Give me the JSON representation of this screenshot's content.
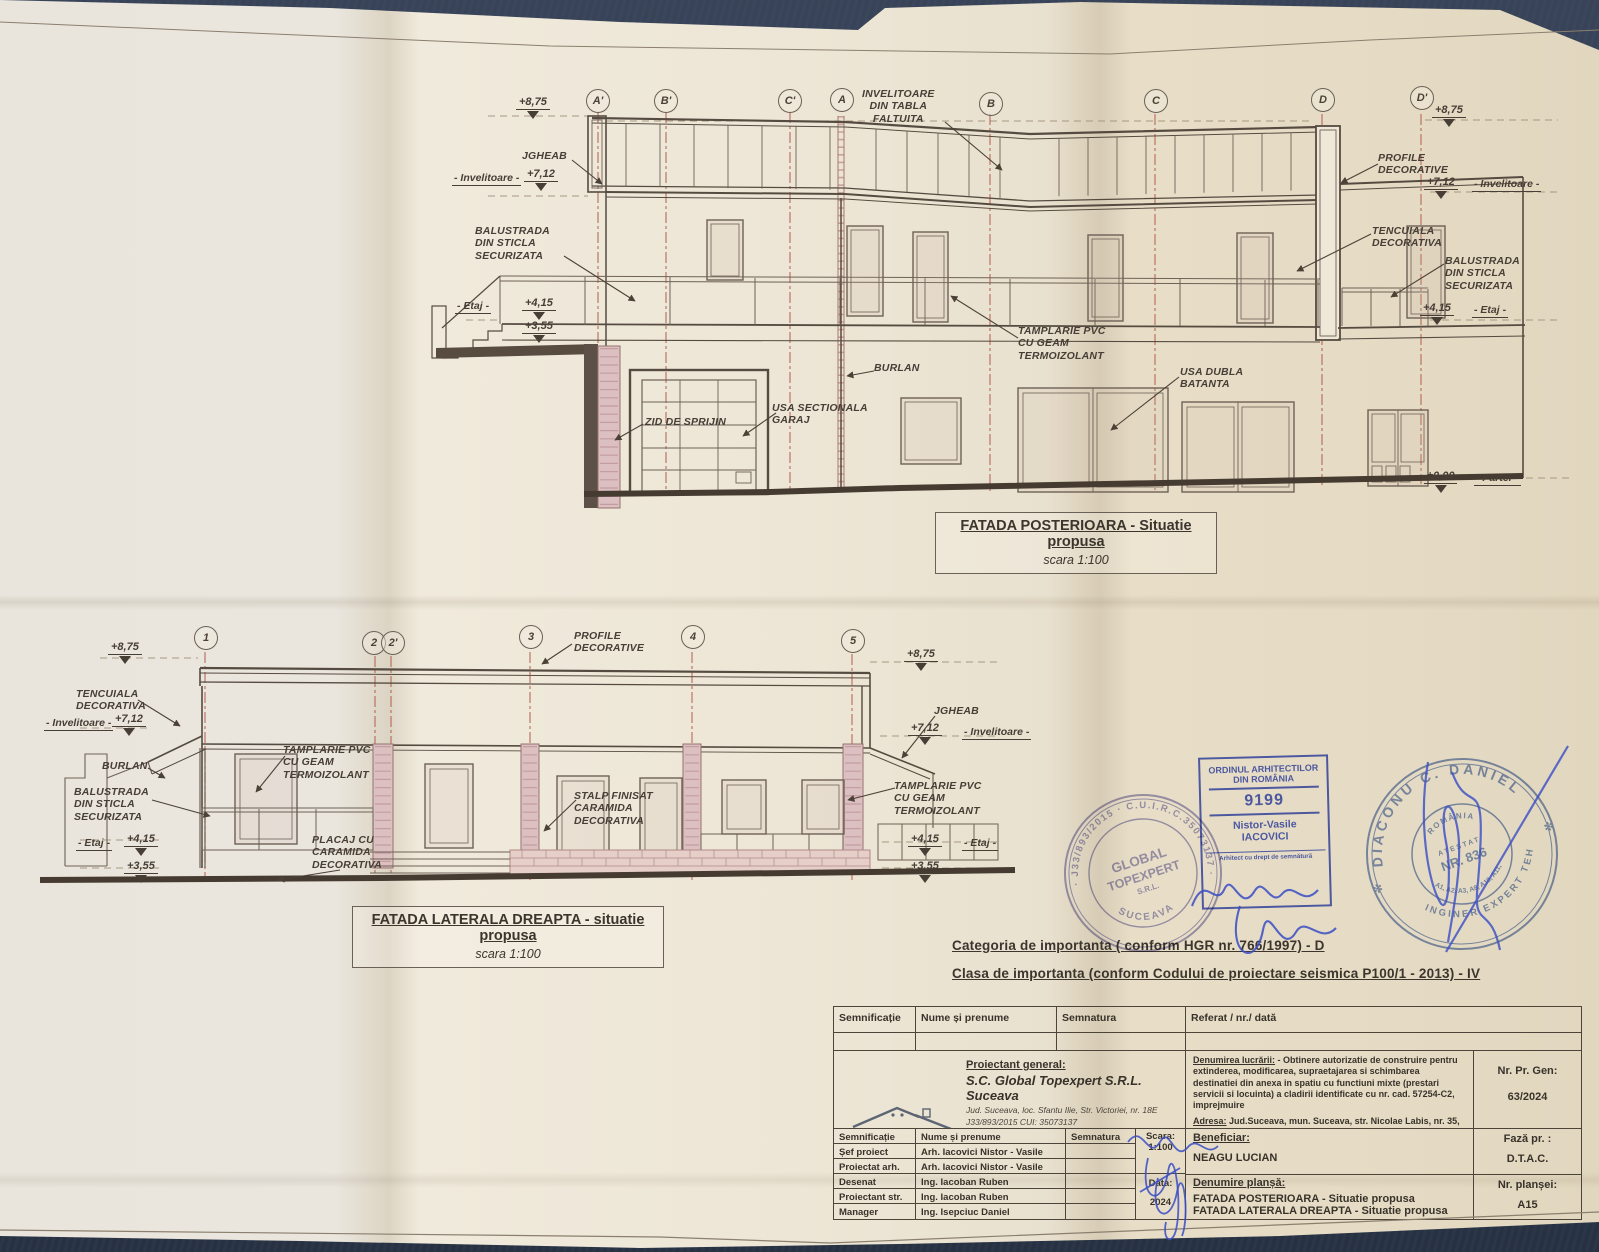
{
  "page": {
    "background": "#2e3a4e",
    "paper": "#eae4d7"
  },
  "top_drawing": {
    "bubbles": [
      "A'",
      "B'",
      "C'",
      "A",
      "B",
      "C",
      "D",
      "D'"
    ],
    "title": "FATADA POSTERIOARA - Situatie propusa",
    "scale": "scara 1:100",
    "labels": {
      "lvl875_left": "+8,75",
      "jgheab": "JGHEAB",
      "invelitoare_left": "- Invelitoare -",
      "lvl712_left": "+7,12",
      "balustrada_left": "BALUSTRADA\nDIN STICLA\nSECURIZATA",
      "etaj_left": "- Etaj -",
      "lvl415_left": "+4,15",
      "lvl355_left": "+3,55",
      "invelitoare_tabla": "INVELITOARE\nDIN TABLA\nFALTUITA",
      "tamplarie": "TAMPLARIE PVC\nCU GEAM\nTERMOIZOLANT",
      "burlan": "BURLAN",
      "usa_sectionala": "USA SECTIONALA\nGARAJ",
      "zid_de_sprijin": "ZID DE SPRIJIN",
      "usa_dubla": "USA DUBLA\nBATANTA",
      "lvl875_right": "+8,75",
      "profile_decorative": "PROFILE\nDECORATIVE",
      "lvl712_right": "+7,12",
      "invelitoare_right": "- Invelitoare -",
      "tencuiala": "TENCUIALA\nDECORATIVA",
      "balustrada_right": "BALUSTRADA\nDIN STICLA\nSECURIZATA",
      "lvl415_right": "+4,15",
      "etaj_right": "- Etaj -",
      "lvl000": "±0,00",
      "parter": "- Parter -"
    }
  },
  "bottom_drawing": {
    "bubbles": [
      "1",
      "2",
      "2'",
      "3",
      "4",
      "5"
    ],
    "title": "FATADA LATERALA DREAPTA - situatie propusa",
    "scale": "scara 1:100",
    "labels": {
      "lvl875_left": "+8,75",
      "tencuiala": "TENCUIALA\nDECORATIVA",
      "invelitoare_left": "- Invelitoare -",
      "lvl712_left": "+7,12",
      "burlan": "BURLAN",
      "balustrada": "BALUSTRADA\nDIN STICLA\nSECURIZATA",
      "etaj_left": "- Etaj -",
      "lvl415_left": "+4,15",
      "lvl355_left": "+3,55",
      "profile_decorative": "PROFILE\nDECORATIVE",
      "tamplarie_mid": "TAMPLARIE PVC\nCU GEAM\nTERMOIZOLANT",
      "placaj": "PLACAJ CU\nCARAMIDA\nDECORATIVA",
      "stalp": "STALP FINISAT\nCARAMIDA\nDECORATIVA",
      "jgheab": "JGHEAB",
      "lvl712_right": "+7,12",
      "invelitoare_right": "- Invelitoare -",
      "tamplarie_right": "TAMPLARIE PVC\nCU GEAM\nTERMOIZOLANT",
      "lvl415_right": "+4,15",
      "etaj_right": "- Etaj -",
      "lvl355_right": "+3,55",
      "lvl875_right": "+8,75"
    }
  },
  "importance": {
    "line1": "Categoria de importanta ( conform HGR nr. 766/1997)  -  D",
    "line2": "Clasa de importanta  (conform Codului de proiectare seismica P100/1 - 2013) - IV"
  },
  "stamps": {
    "global_round": {
      "ring": "· J33/893/2015 · C.U.I.R.C.35073137 ·",
      "name1": "GLOBAL",
      "name2": "TOPEXPERT",
      "name3": "S.R.L.",
      "city": "SUCEAVA"
    },
    "oar": {
      "org1": "ORDINUL ARHITECTILOR",
      "org2": "DIN ROMÂNIA",
      "number": "9199",
      "name1": "Nistor-Vasile",
      "name2": "IACOVICI",
      "footer": "Arhitect cu drept de semnătură"
    },
    "expert": {
      "name": "DIACONU C. DANIEL",
      "country": "ROMÂNIA",
      "atestat": "ATESTAT",
      "nr": "NR. 836",
      "domains": "A1, A2, A3, A8, A10, A11,",
      "bottom": "INGINER EXPERT TEHNIC",
      "star_left": "✻",
      "star_right": "✻"
    }
  },
  "title_block": {
    "header": [
      "Semnificație",
      "Nume și prenume",
      "Semnatura",
      "Referat / nr./ dată"
    ],
    "logo1": "GLOBAL",
    "logo2": "TOPEXPERT",
    "proiectant_label": "Proiectant general:",
    "proiectant_name": "S.C. Global Topexpert S.R.L. Suceava",
    "proiectant_addr": "Jud. Suceava, loc. Sfantu Ilie, Str. Victoriei, nr. 18E",
    "proiectant_reg": "J33/893/2015 CUI: 35073137",
    "denumire_label": "Denumirea lucrării:",
    "denumire_text": "- Obtinere autorizatie de construire pentru extinderea, modificarea, supraetajarea si schimbarea destinatiei din anexa in spatiu cu functiuni mixte (prestari servicii si locuinta) a cladirii identificate cu nr. cad. 57254-C2, imprejmuire",
    "adresa_label": "Adresa:",
    "adresa_text": "Jud.Suceava, mun. Suceava, str. Nicolae Labis, nr. 35, nr. cad. 57254",
    "nr_pr_label": "Nr. Pr. Gen:",
    "nr_pr_value": "63/2024",
    "scara_label": "Scara:",
    "scara_value": "1:100",
    "data_label": "Data:",
    "data_value": "2024",
    "rows": [
      {
        "role": "Șef  proiect",
        "name": "Arh. Iacovici Nistor - Vasile"
      },
      {
        "role": "Proiectat arh.",
        "name": "Arh. Iacovici Nistor - Vasile"
      },
      {
        "role": "Desenat",
        "name": "Ing. Iacoban Ruben"
      },
      {
        "role": "Proiectant str.",
        "name": "Ing. Iacoban Ruben"
      },
      {
        "role": "Manager proiect",
        "name": "Ing. Isepciuc Daniel"
      }
    ],
    "beneficiar_label": "Beneficiar:",
    "beneficiar_value": "NEAGU LUCIAN",
    "faza_label": "Fază  pr. :",
    "faza_value": "D.T.A.C.",
    "plansa_label": "Denumire planșă:",
    "plansa1": "FATADA POSTERIOARA - Situatie propusa",
    "plansa2": "FATADA LATERALA DREAPTA - Situatie propusa",
    "nr_plansei_label": "Nr. planșei:",
    "nr_plansei_value": "A15"
  }
}
